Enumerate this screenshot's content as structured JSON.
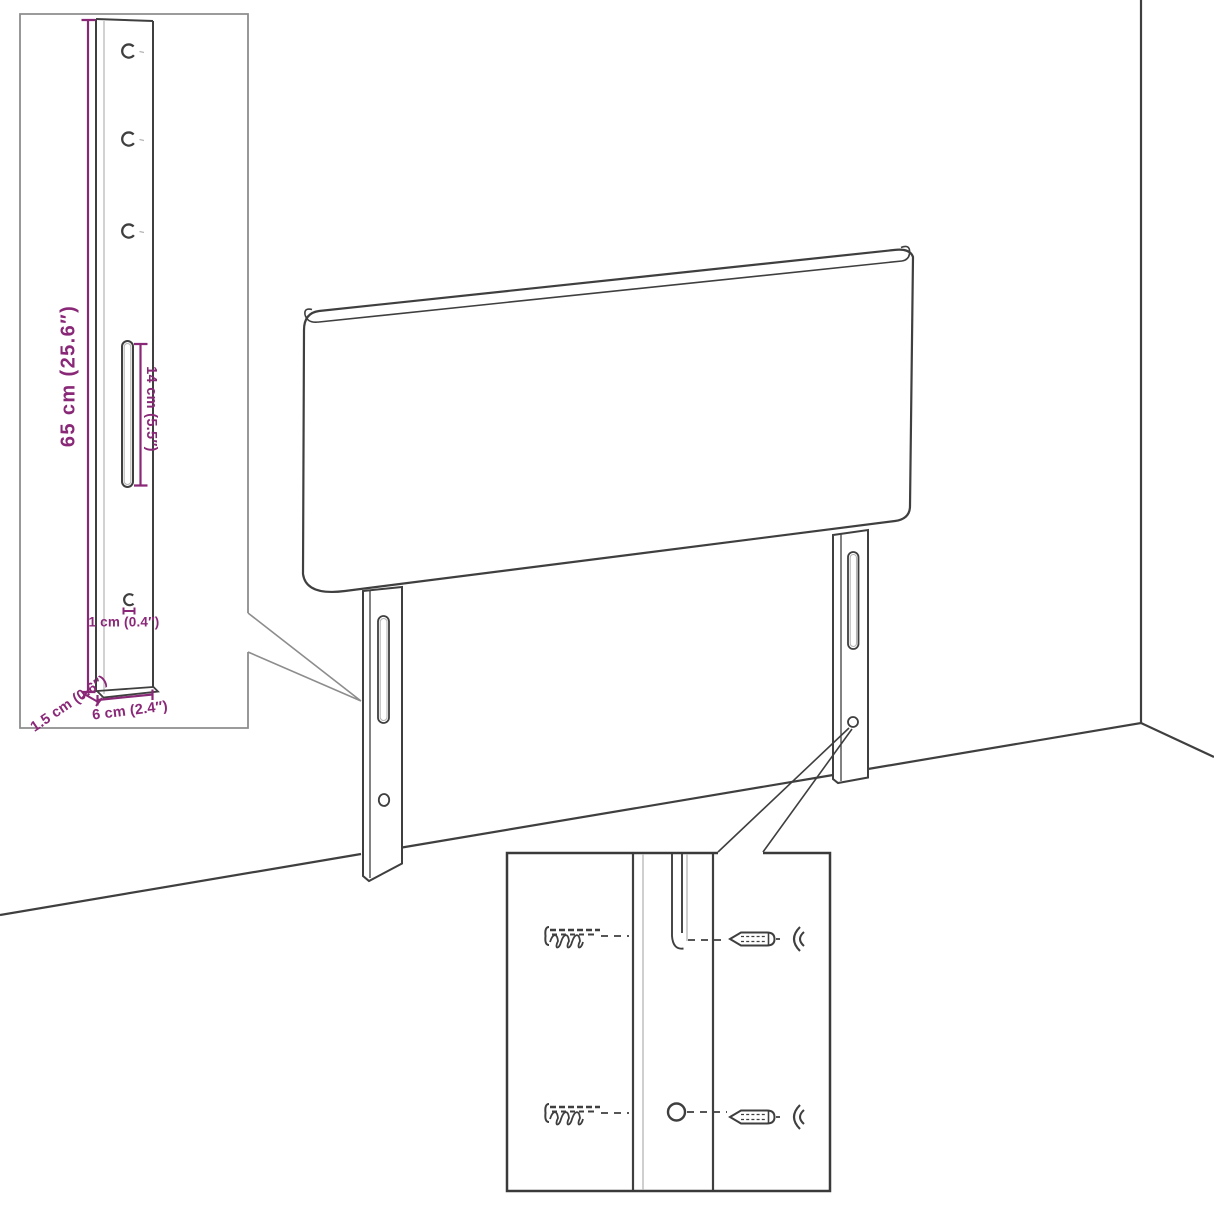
{
  "figure": {
    "type": "furniture-assembly-dimension-diagram",
    "subject": "headboard with two mounting legs standing in a room corner, with a bracket dimension inset and a screw/wall-plug mounting detail inset"
  },
  "dimensions": {
    "height_label": "65 cm (25.6″)",
    "slot_label": "14 cm (5.5″)",
    "hole_offset_label": "1 cm (0.4″)",
    "thickness_label": "1.5 cm (0.6″)",
    "width_label": "6 cm (2.4″)"
  },
  "colors": {
    "dimension": "#8a2878",
    "line_dark": "#3f3f3f",
    "line_light": "#b5b5b5",
    "inset_border": "#8d8d8d",
    "detail_border": "#3a3a3a",
    "background": "#ffffff"
  }
}
